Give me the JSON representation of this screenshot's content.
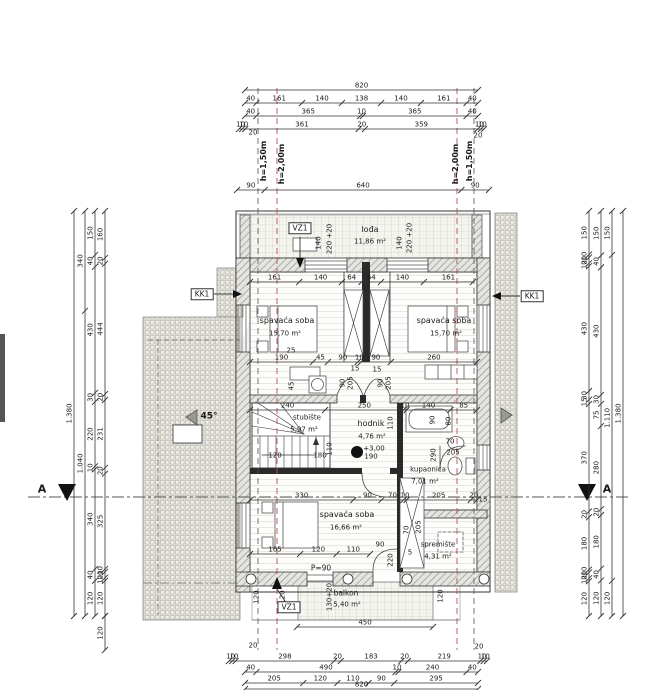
{
  "title": "floor-plan",
  "watermark": {
    "text": "AR"
  },
  "colors": {
    "line": "#3a3a3a",
    "wall_hatch": "#8a8a84",
    "roof_hatch": "#b9b7ac",
    "height_line_red": "#b5534c",
    "height_line_black": "#555555"
  },
  "boxed_labels": [
    {
      "t": "VZ1",
      "x": 300,
      "y": 228
    },
    {
      "t": "KK1",
      "x": 202,
      "y": 294
    },
    {
      "t": "KK1",
      "x": 532,
      "y": 296
    },
    {
      "t": "VZ1",
      "x": 289,
      "y": 607
    }
  ],
  "texts": [
    {
      "t": "20",
      "x": 253,
      "y": 133
    },
    {
      "t": "20",
      "x": 478,
      "y": 136
    },
    {
      "t": "h=1,50m",
      "x": 264,
      "y": 161,
      "r": -90,
      "w": 1,
      "s": 8
    },
    {
      "t": "h=2,00m",
      "x": 282,
      "y": 164,
      "r": -90,
      "w": 1,
      "s": 8
    },
    {
      "t": "h=2,00m",
      "x": 456,
      "y": 164,
      "r": -90,
      "w": 1,
      "s": 8
    },
    {
      "t": "h=1,50m",
      "x": 470,
      "y": 161,
      "r": -90,
      "w": 1,
      "s": 8
    },
    {
      "t": "lođa",
      "x": 370,
      "y": 230,
      "s": 8,
      "n": "room-label"
    },
    {
      "t": "11,86 m²",
      "x": 370,
      "y": 242,
      "n": "room-area"
    },
    {
      "t": "140",
      "x": 319,
      "y": 243,
      "r": -90
    },
    {
      "t": "220 +20",
      "x": 330,
      "y": 239,
      "r": -90
    },
    {
      "t": "140",
      "x": 400,
      "y": 243,
      "r": -90
    },
    {
      "t": "220 +20",
      "x": 410,
      "y": 238,
      "r": -90
    },
    {
      "t": "spavaća soba",
      "x": 287,
      "y": 321,
      "s": 8,
      "n": "room-label"
    },
    {
      "t": "15,70 m²",
      "x": 285,
      "y": 334,
      "n": "room-area"
    },
    {
      "t": "spavaća soba",
      "x": 444,
      "y": 321,
      "s": 8,
      "n": "room-label"
    },
    {
      "t": "15,70 m²",
      "x": 446,
      "y": 334,
      "n": "room-area"
    },
    {
      "t": "25",
      "x": 291,
      "y": 351
    },
    {
      "t": "45",
      "x": 292,
      "y": 386,
      "r": -90
    },
    {
      "t": "15",
      "x": 355,
      "y": 369
    },
    {
      "t": "15",
      "x": 377,
      "y": 370
    },
    {
      "t": "90",
      "x": 343,
      "y": 383,
      "r": -90
    },
    {
      "t": "205",
      "x": 351,
      "y": 383,
      "r": -90
    },
    {
      "t": "90",
      "x": 381,
      "y": 383,
      "r": -90
    },
    {
      "t": "205",
      "x": 389,
      "y": 383,
      "r": -90
    },
    {
      "t": "110",
      "x": 391,
      "y": 423,
      "r": -90
    },
    {
      "t": "90",
      "x": 433,
      "y": 420,
      "r": -90
    },
    {
      "t": "80",
      "x": 449,
      "y": 421,
      "r": -90
    },
    {
      "t": "290",
      "x": 434,
      "y": 455,
      "r": -90
    },
    {
      "t": "stubište",
      "x": 307,
      "y": 418,
      "n": "room-label"
    },
    {
      "t": "5,97 m²",
      "x": 304,
      "y": 430,
      "n": "room-area"
    },
    {
      "t": "hodnik",
      "x": 371,
      "y": 424,
      "s": 8,
      "n": "room-label"
    },
    {
      "t": "4,76 m²",
      "x": 372,
      "y": 437,
      "n": "room-area"
    },
    {
      "t": "+3,00",
      "x": 374,
      "y": 449,
      "n": "level-label"
    },
    {
      "t": "110",
      "x": 330,
      "y": 449,
      "r": -90
    },
    {
      "t": "120",
      "x": 275,
      "y": 456
    },
    {
      "t": "180",
      "x": 320,
      "y": 456
    },
    {
      "t": "190",
      "x": 371,
      "y": 457
    },
    {
      "t": "70",
      "x": 450,
      "y": 442
    },
    {
      "t": "205",
      "x": 453,
      "y": 453
    },
    {
      "t": "kupaonica",
      "x": 428,
      "y": 470,
      "n": "room-label"
    },
    {
      "t": "7,01 m²",
      "x": 425,
      "y": 482,
      "n": "room-area"
    },
    {
      "t": "15",
      "x": 483,
      "y": 500
    },
    {
      "t": "spavaća soba",
      "x": 347,
      "y": 515,
      "s": 8,
      "n": "room-label"
    },
    {
      "t": "16,66 m²",
      "x": 346,
      "y": 528,
      "n": "room-area"
    },
    {
      "t": "70",
      "x": 407,
      "y": 530,
      "r": -90
    },
    {
      "t": "205",
      "x": 419,
      "y": 527,
      "r": -90
    },
    {
      "t": "spremište",
      "x": 438,
      "y": 545,
      "n": "room-label"
    },
    {
      "t": "4,31 m²",
      "x": 438,
      "y": 557,
      "n": "room-area"
    },
    {
      "t": "5",
      "x": 410,
      "y": 553
    },
    {
      "t": "90",
      "x": 380,
      "y": 545
    },
    {
      "t": "220",
      "x": 391,
      "y": 560,
      "r": -90
    },
    {
      "t": "P=90",
      "x": 321,
      "y": 568,
      "s": 7.5,
      "n": "door-label"
    },
    {
      "t": "balkon",
      "x": 346,
      "y": 593,
      "s": 7.5,
      "n": "room-label"
    },
    {
      "t": "5,40 m²",
      "x": 347,
      "y": 605,
      "n": "room-area"
    },
    {
      "t": "120",
      "x": 257,
      "y": 597,
      "r": -90
    },
    {
      "t": "120",
      "x": 283,
      "y": 597,
      "r": -90
    },
    {
      "t": "130+20",
      "x": 330,
      "y": 597,
      "r": -90
    },
    {
      "t": "120",
      "x": 441,
      "y": 596,
      "r": -90
    },
    {
      "t": "20",
      "x": 253,
      "y": 646
    },
    {
      "t": "20",
      "x": 479,
      "y": 647
    },
    {
      "t": "A",
      "x": 42,
      "y": 489,
      "s": 11,
      "w": 1,
      "n": "section-label"
    },
    {
      "t": "A",
      "x": 607,
      "y": 489,
      "s": 11,
      "w": 1,
      "n": "section-label"
    },
    {
      "t": "45°",
      "x": 209,
      "y": 417,
      "s": 9,
      "w": 1,
      "n": "angle-label"
    }
  ],
  "chains": [
    {
      "o": "h",
      "p": 90,
      "a": 245,
      "b": 478,
      "v": [
        "820"
      ]
    },
    {
      "o": "h",
      "p": 103,
      "a": 245,
      "b": 478,
      "v": [
        "40",
        "161",
        "140",
        "138",
        "140",
        "161",
        "40"
      ]
    },
    {
      "o": "h",
      "p": 116,
      "a": 245,
      "b": 478,
      "v": [
        "40",
        "365",
        "10",
        "365",
        "40"
      ]
    },
    {
      "o": "h",
      "p": 129,
      "a": 239,
      "b": 484,
      "v": [
        "10",
        "10",
        "361",
        "20",
        "359",
        "10",
        "10"
      ]
    },
    {
      "o": "h",
      "p": 190,
      "a": 237,
      "b": 489,
      "v": [
        "90",
        "640",
        "90"
      ]
    },
    {
      "o": "h",
      "p": 282,
      "a": 250,
      "b": 473,
      "v": [
        "161",
        "140",
        "64",
        "64",
        "140",
        "161"
      ]
    },
    {
      "o": "h",
      "p": 362,
      "a": 250,
      "b": 477,
      "v": [
        "190",
        "45",
        "90",
        "10",
        "90",
        "260"
      ]
    },
    {
      "o": "h",
      "p": 410,
      "a": 250,
      "b": 477,
      "v": [
        "240",
        "250",
        "10",
        "140",
        "85"
      ]
    },
    {
      "o": "h",
      "p": 500,
      "a": 250,
      "b": 477,
      "v": [
        "330",
        "90",
        "70",
        "10",
        "205",
        "20"
      ]
    },
    {
      "o": "h",
      "p": 554,
      "a": 250,
      "b": 370,
      "v": [
        "165",
        "120",
        "110"
      ]
    },
    {
      "o": "h",
      "p": 627,
      "a": 297,
      "b": 433,
      "v": [
        "450"
      ]
    },
    {
      "o": "h",
      "p": 661,
      "a": 229,
      "b": 487,
      "v": [
        "10",
        "10",
        "298",
        "20",
        "183",
        "20",
        "219",
        "10",
        "10"
      ]
    },
    {
      "o": "h",
      "p": 672,
      "a": 245,
      "b": 478,
      "v": [
        "40",
        "490",
        "10",
        "240",
        "40"
      ]
    },
    {
      "o": "h",
      "p": 683,
      "a": 245,
      "b": 478,
      "v": [
        "205",
        "120",
        "110",
        "90",
        "295"
      ]
    },
    {
      "o": "h",
      "p": 689,
      "a": 245,
      "b": 478,
      "v": [
        "820"
      ]
    },
    {
      "o": "v",
      "p": 74,
      "a": 211,
      "b": 616,
      "v": [
        "1.380"
      ]
    },
    {
      "o": "v",
      "p": 85,
      "a": 211,
      "b": 616,
      "v": [
        "340",
        "1.040"
      ]
    },
    {
      "o": "v",
      "p": 95,
      "a": 211,
      "b": 616,
      "v": [
        "150",
        "40",
        "430",
        "30",
        "220",
        "10",
        "340",
        "40",
        "120"
      ]
    },
    {
      "o": "v",
      "p": 105,
      "a": 211,
      "b": 616,
      "v": [
        "160",
        "20",
        "444",
        "20",
        "231",
        "20",
        "325",
        "10",
        "20",
        "10",
        "120"
      ]
    },
    {
      "o": "v",
      "p": 105,
      "a": 616,
      "b": 650,
      "v": [
        "120"
      ]
    },
    {
      "o": "v",
      "p": 589,
      "a": 211,
      "b": 616,
      "v": [
        "150",
        "10",
        "20",
        "10",
        "430",
        "30",
        "15",
        "370",
        "20",
        "180",
        "10",
        "20",
        "10",
        "120"
      ]
    },
    {
      "o": "v",
      "p": 601,
      "a": 211,
      "b": 616,
      "v": [
        "150",
        "40",
        "430",
        "30",
        "75",
        "280",
        "20",
        "180",
        "40",
        "120"
      ]
    },
    {
      "o": "v",
      "p": 612,
      "a": 211,
      "b": 616,
      "v": [
        "150",
        "1.110",
        "120"
      ]
    },
    {
      "o": "v",
      "p": 623,
      "a": 211,
      "b": 616,
      "v": [
        "1.380"
      ]
    }
  ]
}
